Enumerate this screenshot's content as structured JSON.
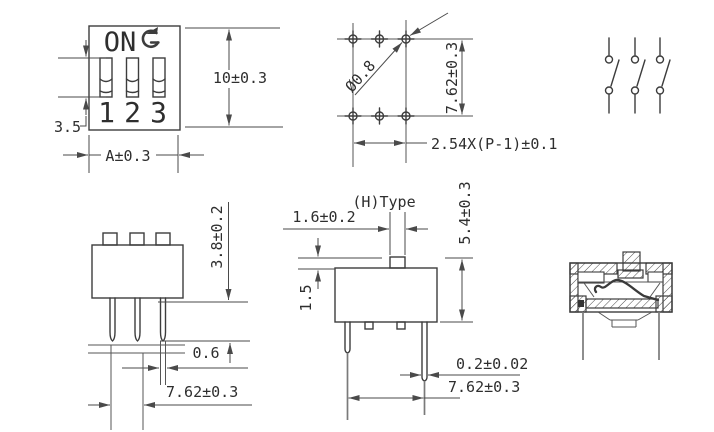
{
  "title": "DIP switch technical drawing",
  "colors": {
    "line": "#3d3d3d",
    "light_line": "#7a7a7a",
    "text": "#2e2e2e",
    "background": "#ffffff"
  },
  "front_view": {
    "on_label": "ON",
    "positions": [
      "1",
      "2",
      "3"
    ],
    "dim_slot": "3.5",
    "dim_height": "10±0.3",
    "dim_width": "A±0.3"
  },
  "pcb_view": {
    "dim_hole_diameter": "Ø0.8",
    "dim_row_spacing": "7.62±0.3",
    "dim_pitch": "2.54X(P-1)±0.1"
  },
  "side_view": {
    "dim_body_height": "3.8±0.2",
    "dim_pin_width": "0.6",
    "dim_pin_span": "7.62±0.3"
  },
  "h_type_view": {
    "title": "(H)Type",
    "dim_actuator_width": "1.6±0.2",
    "dim_actuator_protrusion": "1.5",
    "dim_overall_height": "5.4±0.3",
    "dim_pin_thickness": "0.2±0.02",
    "dim_pin_span": "7.62±0.3"
  }
}
